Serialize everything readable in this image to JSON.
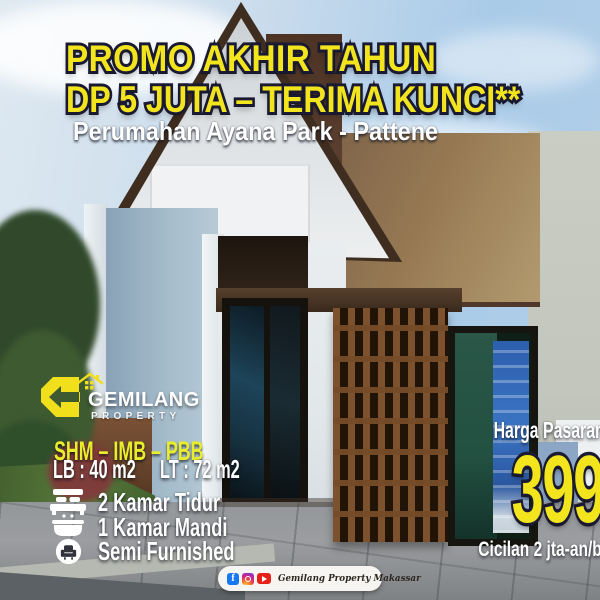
{
  "flyer": {
    "headline_line1": "PROMO AKHIR TAHUN",
    "headline_line2": "DP 5 JUTA – TERIMA KUNCI**",
    "subtitle": "Perumahan Ayana Park - Pattene"
  },
  "logo": {
    "name": "GEMILANG",
    "tagline": "PROPERTY"
  },
  "details": {
    "certificates": "SHM – IMB – PBB",
    "building_area": "LB : 40 m2",
    "land_area": "LT : 72 m2",
    "features": [
      {
        "icon": "bed-icon",
        "label": "2 Kamar Tidur"
      },
      {
        "icon": "bath-icon",
        "label": "1 Kamar Mandi"
      },
      {
        "icon": "sofa-icon",
        "label": "Semi Furnished"
      }
    ]
  },
  "pricing": {
    "market_price": "Harga Pasaran 500 jt-an !",
    "price": "399 JT",
    "installment": "Cicilan 2 jta-an/bulan"
  },
  "footer": {
    "facebook_glyph": "f",
    "social_icons": [
      "facebook-icon",
      "instagram-icon",
      "youtube-icon"
    ],
    "brand": "Gemilang Property Makassar"
  },
  "colors": {
    "accent_yellow": "#F3E51D",
    "outline_navy": "#1A1A33",
    "certs_yellow": "#E9EE2A",
    "text_white": "#FFFFFF",
    "facebook_blue": "#1877F2",
    "youtube_red": "#E62117"
  }
}
